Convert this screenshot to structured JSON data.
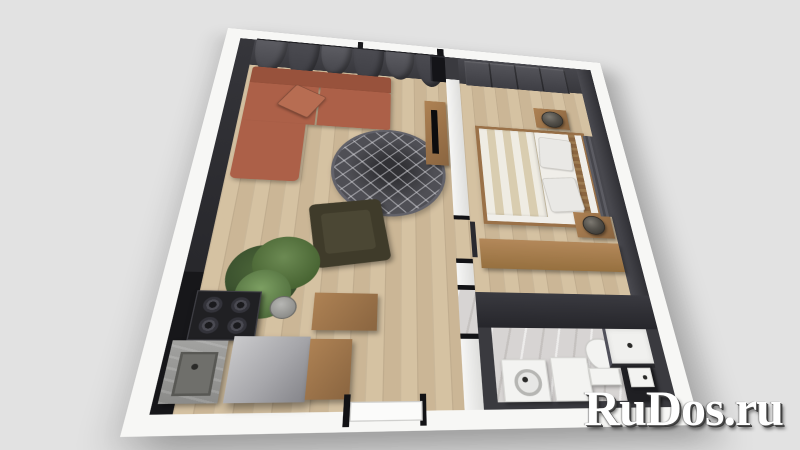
{
  "meta": {
    "description": "3D rendered floor plan of a one-room apartment viewed from above",
    "style": "photoreal top-down 3D render on plain light gray background"
  },
  "watermark": {
    "text": "RuDos.ru"
  },
  "palette": {
    "bg": "#e2e2e2",
    "wall-white": "#f7f7f5",
    "wall-dark": "#3a3a3f",
    "wall-deep": "#1b1b1e",
    "wood": "#d2bd9b",
    "marble": "#d7d4d3",
    "sofa": "#ac6048",
    "sofa-dark": "#98523c",
    "rug": "#4f4f55",
    "chair": "#3f3b2a",
    "plant": "#55713f",
    "furn-wood": "#ae8254",
    "furn-wood-dark": "#8a6540",
    "fridge-a": "#cacacc",
    "fridge-b": "#85858a",
    "appliance": "#202023",
    "fixture": "#f3f3f1",
    "bedding-a": "#efece3",
    "bedding-b": "#d9cdb0",
    "curtain-a": "#5c5c62",
    "curtain-b": "#4b4b51",
    "lamp": "#55524c",
    "watermark": "#ffffff"
  },
  "rooms": [
    {
      "name": "living-room-with-kitchen",
      "floor": "light wood planks",
      "items": [
        "gray curtains along top wall",
        "terracotta corner sofa with cushion",
        "round dark gray trellis rug",
        "dark olive armchair",
        "potted plant",
        "wood TV stand with black TV",
        "black gas stove",
        "gray counter with sink",
        "tall gray refrigerator",
        "wood cabinets",
        "entrance door in bottom wall"
      ]
    },
    {
      "name": "bedroom",
      "floor": "light wood planks",
      "items": [
        "dark sliding wardrobe",
        "double bed with striped duvet and two gray pillows",
        "slatted wood headboard",
        "two wood nightstands with dark cylindrical lamps",
        "long wood dresser",
        "gray panel by headboard"
      ]
    },
    {
      "name": "bathroom",
      "floor": "gray marble",
      "items": [
        "washing machine with round door",
        "white storage cabinet",
        "toilet",
        "white shower tray with dark glass",
        "dark vanity with white sink"
      ]
    }
  ]
}
